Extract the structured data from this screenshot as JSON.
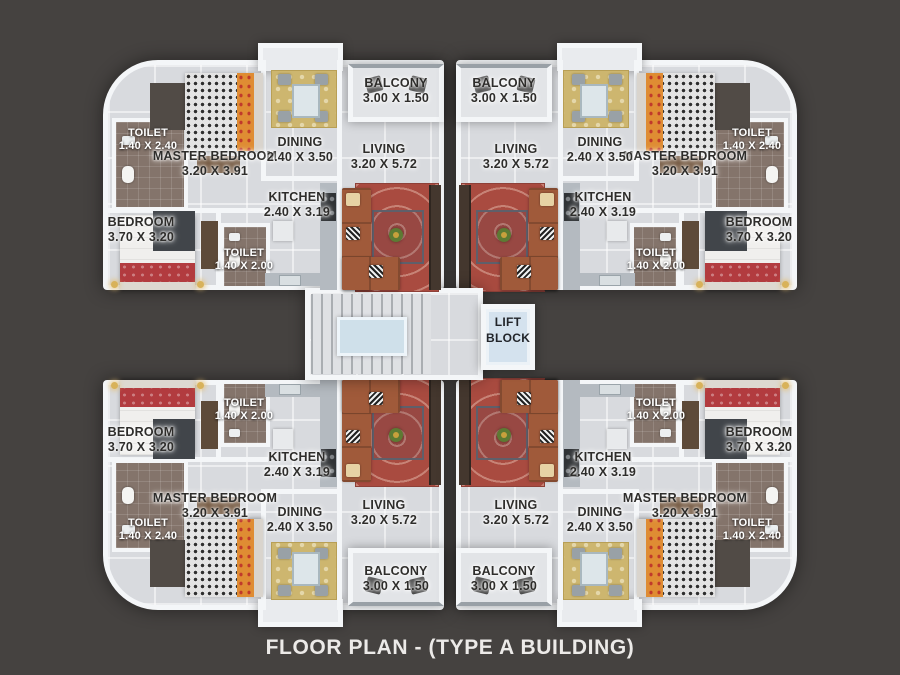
{
  "title": "FLOOR PLAN - (TYPE A BUILDING)",
  "lift": {
    "line1": "LIFT",
    "line2": "BLOCK"
  },
  "units": {
    "top_left": {
      "rooms": {
        "toilet_corner": {
          "name": "TOILET",
          "dims": "1.40 X 2.40"
        },
        "master_bedroom": {
          "name": "MASTER BEDROOM",
          "dims": "3.20 X 3.91"
        },
        "dining": {
          "name": "DINING",
          "dims": "2.40 X 3.50"
        },
        "balcony": {
          "name": "BALCONY",
          "dims": "3.00 X 1.50"
        },
        "living": {
          "name": "LIVING",
          "dims": "3.20 X 5.72"
        },
        "kitchen": {
          "name": "KITCHEN",
          "dims": "2.40 X 3.19"
        },
        "toilet_inner": {
          "name": "TOILET",
          "dims": "1.40 X 2.00"
        },
        "bedroom": {
          "name": "BEDROOM",
          "dims": "3.70 X 3.20"
        }
      }
    },
    "top_right": {
      "rooms": {
        "toilet_corner": {
          "name": "TOILET",
          "dims": "1.40 X 2.40"
        },
        "master_bedroom": {
          "name": "MASTER BEDROOM",
          "dims": "3.20 X 3.91"
        },
        "dining": {
          "name": "DINING",
          "dims": "2.40 X 3.50"
        },
        "balcony": {
          "name": "BALCONY",
          "dims": "3.00 X 1.50"
        },
        "living": {
          "name": "LIVING",
          "dims": "3.20 X 5.72"
        },
        "kitchen": {
          "name": "KITCHEN",
          "dims": "2.40 X 3.19"
        },
        "toilet_inner": {
          "name": "TOILET",
          "dims": "1.40 X 2.00"
        },
        "bedroom": {
          "name": "BEDROOM",
          "dims": "3.70 X 3.20"
        }
      }
    },
    "bottom_left": {
      "rooms": {
        "toilet_corner": {
          "name": "TOILET",
          "dims": "1.40 X 2.40"
        },
        "master_bedroom": {
          "name": "MASTER BEDROOM",
          "dims": "3.20 X 3.91"
        },
        "dining": {
          "name": "DINING",
          "dims": "2.40 X 3.50"
        },
        "balcony": {
          "name": "BALCONY",
          "dims": "3.00 X 1.50"
        },
        "living": {
          "name": "LIVING",
          "dims": "3.20 X 5.72"
        },
        "kitchen": {
          "name": "KITCHEN",
          "dims": "2.40 X 3.19"
        },
        "toilet_inner": {
          "name": "TOILET",
          "dims": "1.40 X 2.00"
        },
        "bedroom": {
          "name": "BEDROOM",
          "dims": "3.70 X 3.20"
        }
      }
    },
    "bottom_right": {
      "rooms": {
        "toilet_corner": {
          "name": "TOILET",
          "dims": "1.40 X 2.40"
        },
        "master_bedroom": {
          "name": "MASTER BEDROOM",
          "dims": "3.20 X 3.91"
        },
        "dining": {
          "name": "DINING",
          "dims": "2.40 X 3.50"
        },
        "balcony": {
          "name": "BALCONY",
          "dims": "3.00 X 1.50"
        },
        "living": {
          "name": "LIVING",
          "dims": "3.20 X 5.72"
        },
        "kitchen": {
          "name": "KITCHEN",
          "dims": "2.40 X 3.19"
        },
        "toilet_inner": {
          "name": "TOILET",
          "dims": "1.40 X 2.00"
        },
        "bedroom": {
          "name": "BEDROOM",
          "dims": "3.70 X 3.20"
        }
      }
    }
  },
  "colors": {
    "bg": "#454240",
    "wall": "#f4f6f8",
    "floor": "#d8dade",
    "toilet_floor": "#84746b",
    "dining_rug": "#cdb66f",
    "living_rug": "#a94b40",
    "sofa": "#a05a3a",
    "counter": "#b4bac0",
    "lift_blue": "#d4e2ee",
    "bed_red": "#b23b3f",
    "pillow_orange": "#df8c33",
    "label_dark": "#2e2d2b",
    "title_color": "#eceae8"
  }
}
